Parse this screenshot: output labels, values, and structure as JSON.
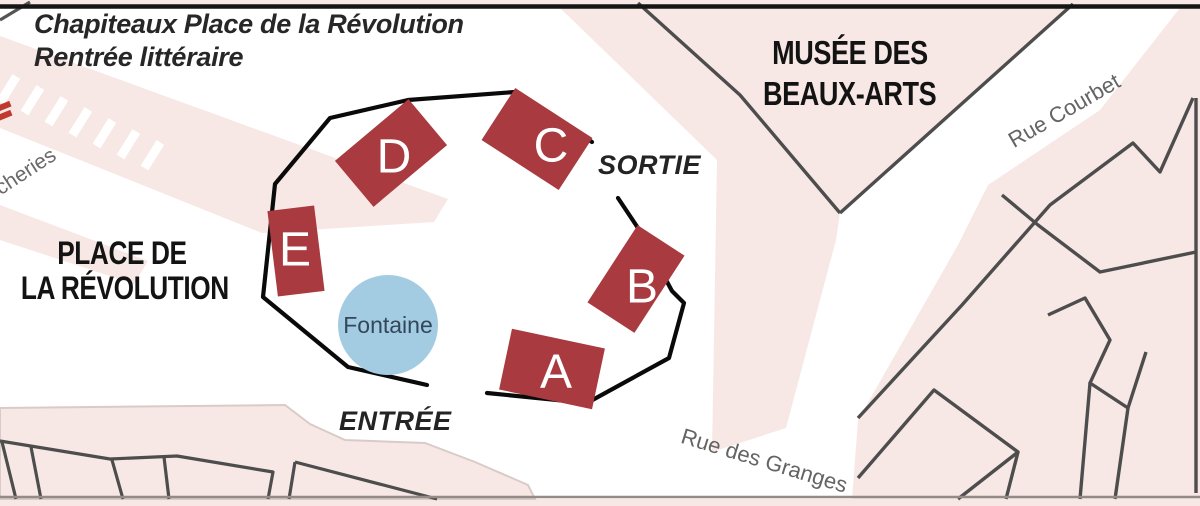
{
  "map": {
    "title": {
      "line1": "Chapiteaux Place de la Révolution",
      "line2": "Rentrée littéraire"
    },
    "areas": {
      "place_line1": "PLACE DE",
      "place_line2": "LA RÉVOLUTION",
      "museum_line1": "MUSÉE DES",
      "museum_line2": "BEAUX-ARTS"
    },
    "streets": {
      "courbet": "Rue Courbet",
      "granges": "Rue des Granges",
      "boucheries_partial": "cheries"
    },
    "markers": {
      "exit": "SORTIE",
      "entrance": "ENTRÉE",
      "fountain": "Fontaine"
    },
    "tents": [
      {
        "label": "A"
      },
      {
        "label": "B"
      },
      {
        "label": "C"
      },
      {
        "label": "D"
      },
      {
        "label": "E"
      }
    ],
    "colors": {
      "tent_red": "#a93a3f",
      "fountain_blue": "#a3cbe2",
      "block_pink": "#f7e8e5",
      "building_gray": "#4d4d4d",
      "enclosure_black": "#0a0a0a",
      "crosswalk_red": "#c0392f",
      "border_black": "#151515",
      "baseline_gray": "#948b86"
    }
  }
}
